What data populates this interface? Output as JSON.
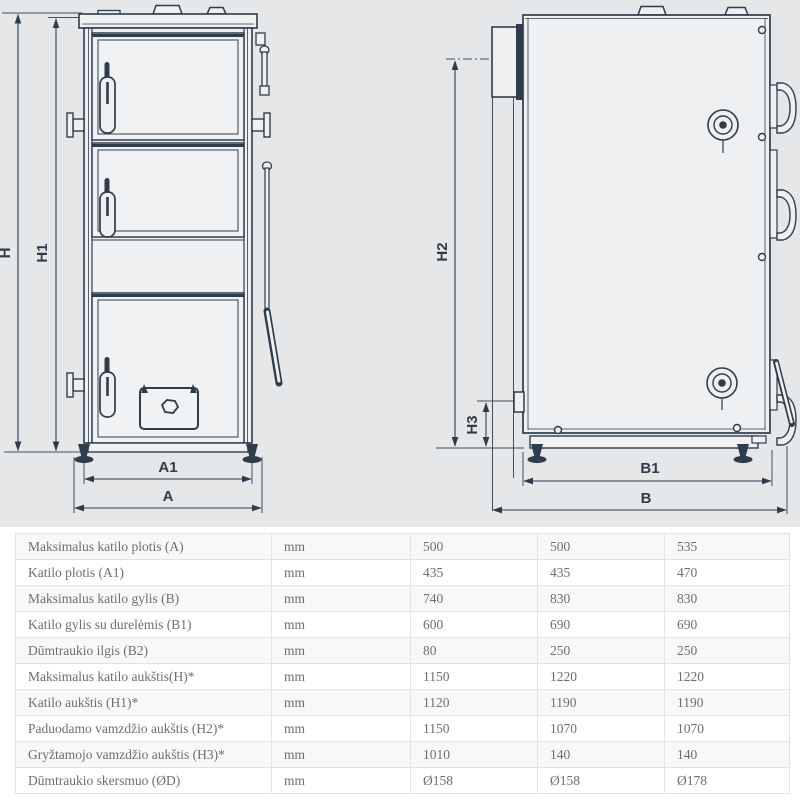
{
  "diagram": {
    "description": "Solid fuel boiler technical drawing, front view and side view with dimension lines",
    "dims": {
      "h": "H",
      "h1": "H1",
      "h2": "H2",
      "h3": "H3",
      "a": "A",
      "a1": "A1",
      "b": "B",
      "b1": "B1"
    },
    "colors": {
      "background": "#e5e7e9",
      "line": "#2e3d4c",
      "body_fill": "#eef0f1",
      "panel_fill": "#f0f2f3"
    }
  },
  "table": {
    "rows": [
      {
        "label": "Maksimalus katilo plotis (A)",
        "unit": "mm",
        "values": [
          "500",
          "500",
          "535"
        ]
      },
      {
        "label": "Katilo plotis (A1)",
        "unit": "mm",
        "values": [
          "435",
          "435",
          "470"
        ]
      },
      {
        "label": "Maksimalus katilo gylis (B)",
        "unit": "mm",
        "values": [
          "740",
          "830",
          "830"
        ]
      },
      {
        "label": "Katilo gylis su durelėmis (B1)",
        "unit": "mm",
        "values": [
          "600",
          "690",
          "690"
        ]
      },
      {
        "label": "Dūmtraukio ilgis (B2)",
        "unit": "mm",
        "values": [
          "80",
          "250",
          "250"
        ]
      },
      {
        "label": "Maksimalus katilo aukštis(H)*",
        "unit": "mm",
        "values": [
          "1150",
          "1220",
          "1220"
        ]
      },
      {
        "label": "Katilo aukštis (H1)*",
        "unit": "mm",
        "values": [
          "1120",
          "1190",
          "1190"
        ]
      },
      {
        "label": "Paduodamo vamzdžio aukštis (H2)*",
        "unit": "mm",
        "values": [
          "1150",
          "1070",
          "1070"
        ]
      },
      {
        "label": "Gryžtamojo vamzdžio aukštis (H3)*",
        "unit": "mm",
        "values": [
          "1010",
          "140",
          "140"
        ]
      },
      {
        "label": "Dūmtraukio skersmuo (ØD)",
        "unit": "mm",
        "values": [
          "Ø158",
          "Ø158",
          "Ø178"
        ]
      }
    ]
  }
}
